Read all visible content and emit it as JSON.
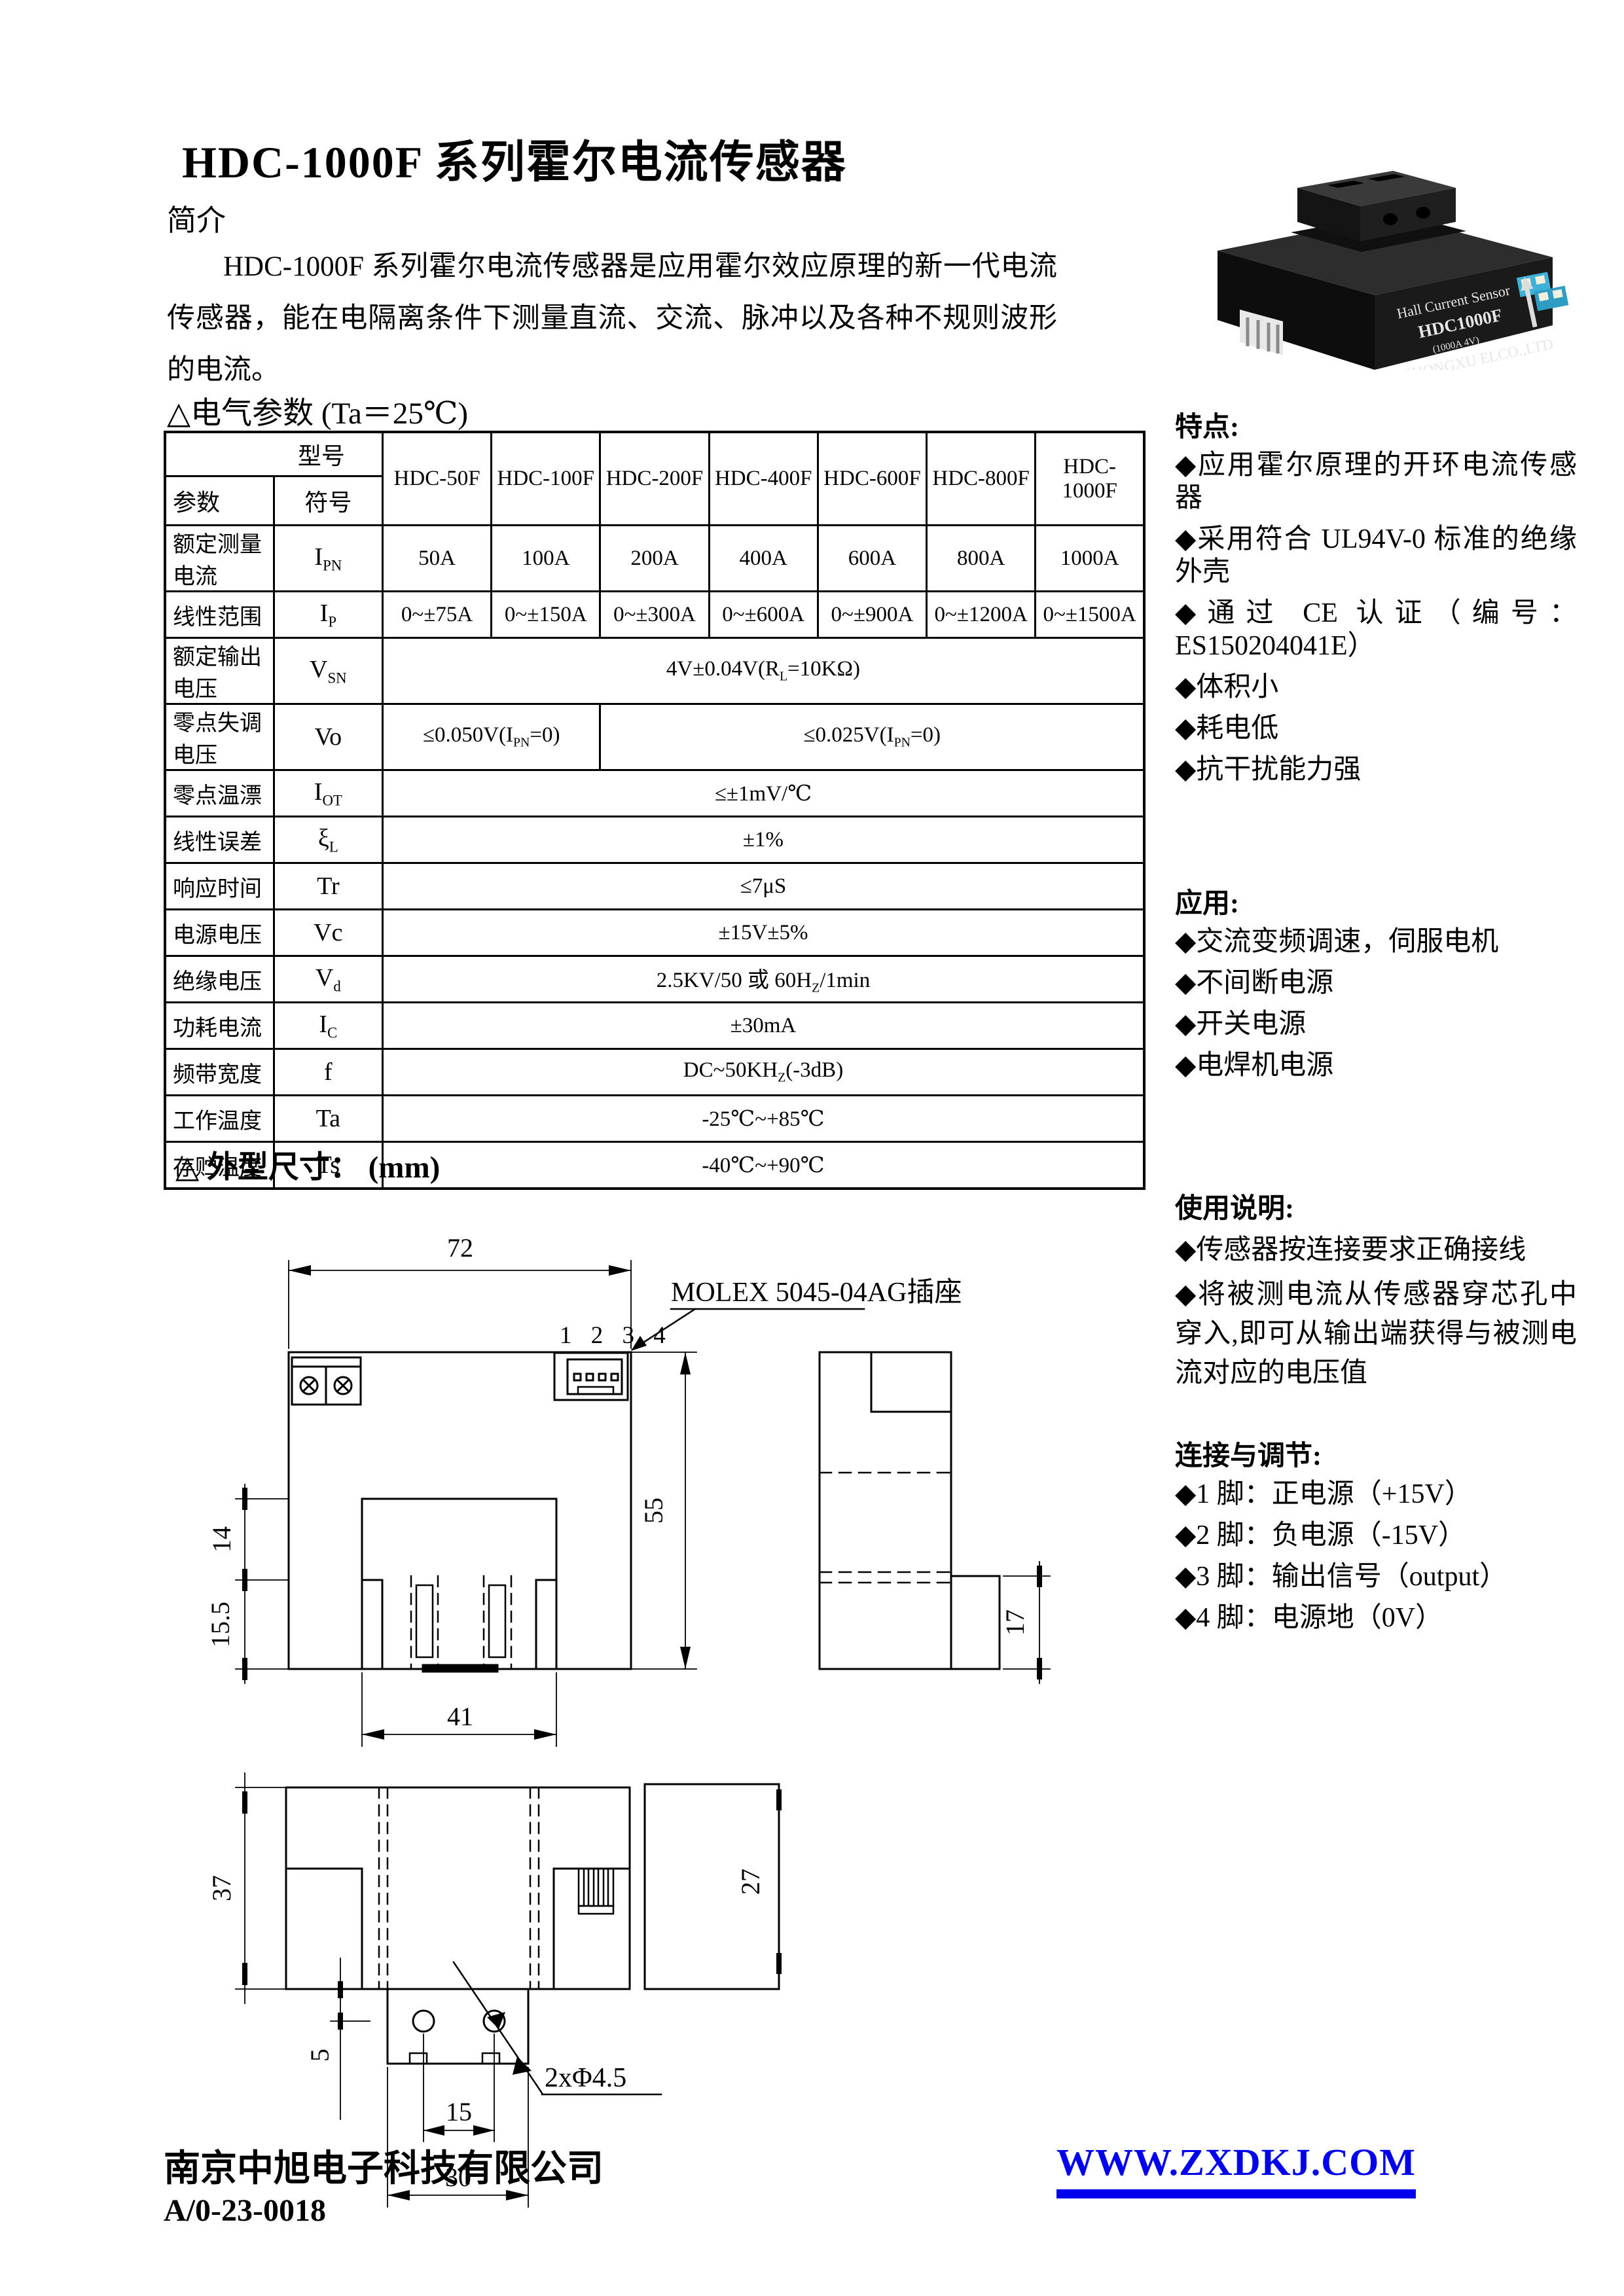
{
  "title": "HDC-1000F 系列霍尔电流传感器",
  "intro": {
    "heading": "简介",
    "body": "HDC-1000F 系列霍尔电流传感器是应用霍尔效应原理的新一代电流传感器，能在电隔离条件下测量直流、交流、脉冲以及各种不规则波形的电流。"
  },
  "product_photo": {
    "line1": "Hall Current Sensor",
    "line2": "HDC1000F",
    "line3": "(1000A 4V)",
    "line4": "ZHONGXU ELCO.,LTD"
  },
  "params_section": {
    "heading": "△电气参数",
    "condition": "(Ta＝25℃)"
  },
  "table": {
    "corner_top": "型号",
    "corner_param": "参数",
    "corner_sym": "符号",
    "models": [
      "HDC-50F",
      "HDC-100F",
      "HDC-200F",
      "HDC-400F",
      "HDC-600F",
      "HDC-800F",
      "HDC-1000F"
    ],
    "rows": [
      {
        "param": "额定测量电流",
        "sym": "I_{PN}",
        "cells": [
          {
            "t": "50A"
          },
          {
            "t": "100A"
          },
          {
            "t": "200A"
          },
          {
            "t": "400A"
          },
          {
            "t": "600A"
          },
          {
            "t": "800A"
          },
          {
            "t": "1000A"
          }
        ]
      },
      {
        "param": "线性范围",
        "sym": "I_{P}",
        "cells": [
          {
            "t": "0~±75A"
          },
          {
            "t": "0~±150A"
          },
          {
            "t": "0~±300A"
          },
          {
            "t": "0~±600A"
          },
          {
            "t": "0~±900A"
          },
          {
            "t": "0~±1200A"
          },
          {
            "t": "0~±1500A"
          }
        ]
      },
      {
        "param": "额定输出电压",
        "sym": "V_{SN}",
        "cells": [
          {
            "t": "4V±0.04V(R_{L}=10KΩ)",
            "span": 7
          }
        ]
      },
      {
        "param": "零点失调电压",
        "sym": "Vo",
        "cells": [
          {
            "t": "≤0.050V(I_{PN}=0)",
            "span": 2
          },
          {
            "t": "≤0.025V(I_{PN}=0)",
            "span": 5
          }
        ]
      },
      {
        "param": "零点温漂",
        "sym": "I_{OT}",
        "cells": [
          {
            "t": "≤±1mV/℃",
            "span": 7
          }
        ]
      },
      {
        "param": "线性误差",
        "sym": "ξ_{L}",
        "cells": [
          {
            "t": "±1%",
            "span": 7
          }
        ]
      },
      {
        "param": "响应时间",
        "sym": "Tr",
        "cells": [
          {
            "t": "≤7μS",
            "span": 7
          }
        ]
      },
      {
        "param": "电源电压",
        "sym": "Vc",
        "cells": [
          {
            "t": "±15V±5%",
            "span": 7
          }
        ]
      },
      {
        "param": "绝缘电压",
        "sym": "V_{d}",
        "cells": [
          {
            "t": "2.5KV/50 或 60H_{Z}/1min",
            "span": 7
          }
        ]
      },
      {
        "param": "功耗电流",
        "sym": "I_{C}",
        "cells": [
          {
            "t": "±30mA",
            "span": 7
          }
        ]
      },
      {
        "param": "频带宽度",
        "sym": "f",
        "cells": [
          {
            "t": "DC~50KH_{Z}(-3dB)",
            "span": 7
          }
        ]
      },
      {
        "param": "工作温度",
        "sym": "Ta",
        "cells": [
          {
            "t": "-25℃~+85℃",
            "span": 7
          }
        ]
      },
      {
        "param": "存贮温度",
        "sym": "Ts",
        "cells": [
          {
            "t": "-40℃~+90℃",
            "span": 7
          }
        ]
      }
    ]
  },
  "features": {
    "heading": "特点:",
    "items": [
      "◆应用霍尔原理的开环电流传感器",
      "◆采用符合 UL94V-0 标准的绝缘外壳",
      "◆通过 CE 认证（编号：ES150204041E）",
      "◆体积小",
      "◆耗电低",
      "◆抗干扰能力强"
    ]
  },
  "applications": {
    "heading": "应用:",
    "items": [
      "◆交流变频调速，伺服电机",
      "◆不间断电源",
      "◆开关电源",
      "◆电焊机电源"
    ]
  },
  "usage": {
    "heading": "使用说明:",
    "items": [
      "◆传感器按连接要求正确接线",
      "◆将被测电流从传感器穿芯孔中穿入,即可从输出端获得与被测电流对应的电压值"
    ]
  },
  "connection": {
    "heading": "连接与调节:",
    "items": [
      "◆1 脚：正电源（+15V）",
      "◆2 脚：负电源（-15V）",
      "◆3 脚：输出信号（output）",
      "◆4 脚：电源地（0V）"
    ]
  },
  "dims_section": {
    "heading": "△ 外型尺寸：",
    "unit": "(mm)"
  },
  "drawing": {
    "molex_label": "MOLEX 5045-04AG插座",
    "pin_numbers": "1 2 3 4",
    "dim_72": "72",
    "dim_55": "55",
    "dim_14": "14",
    "dim_15_5": "15.5",
    "dim_41": "41",
    "dim_17": "17",
    "dim_37": "37",
    "dim_27": "27",
    "dim_5": "5",
    "dim_15": "15",
    "dim_30": "30",
    "holes_label": "2xΦ4.5"
  },
  "footer": {
    "company": "南京中旭电子科技有限公司",
    "doc_code": "A/0-23-0018",
    "website": "WWW.ZXDKJ.COM",
    "website_color": "#0000ee"
  }
}
